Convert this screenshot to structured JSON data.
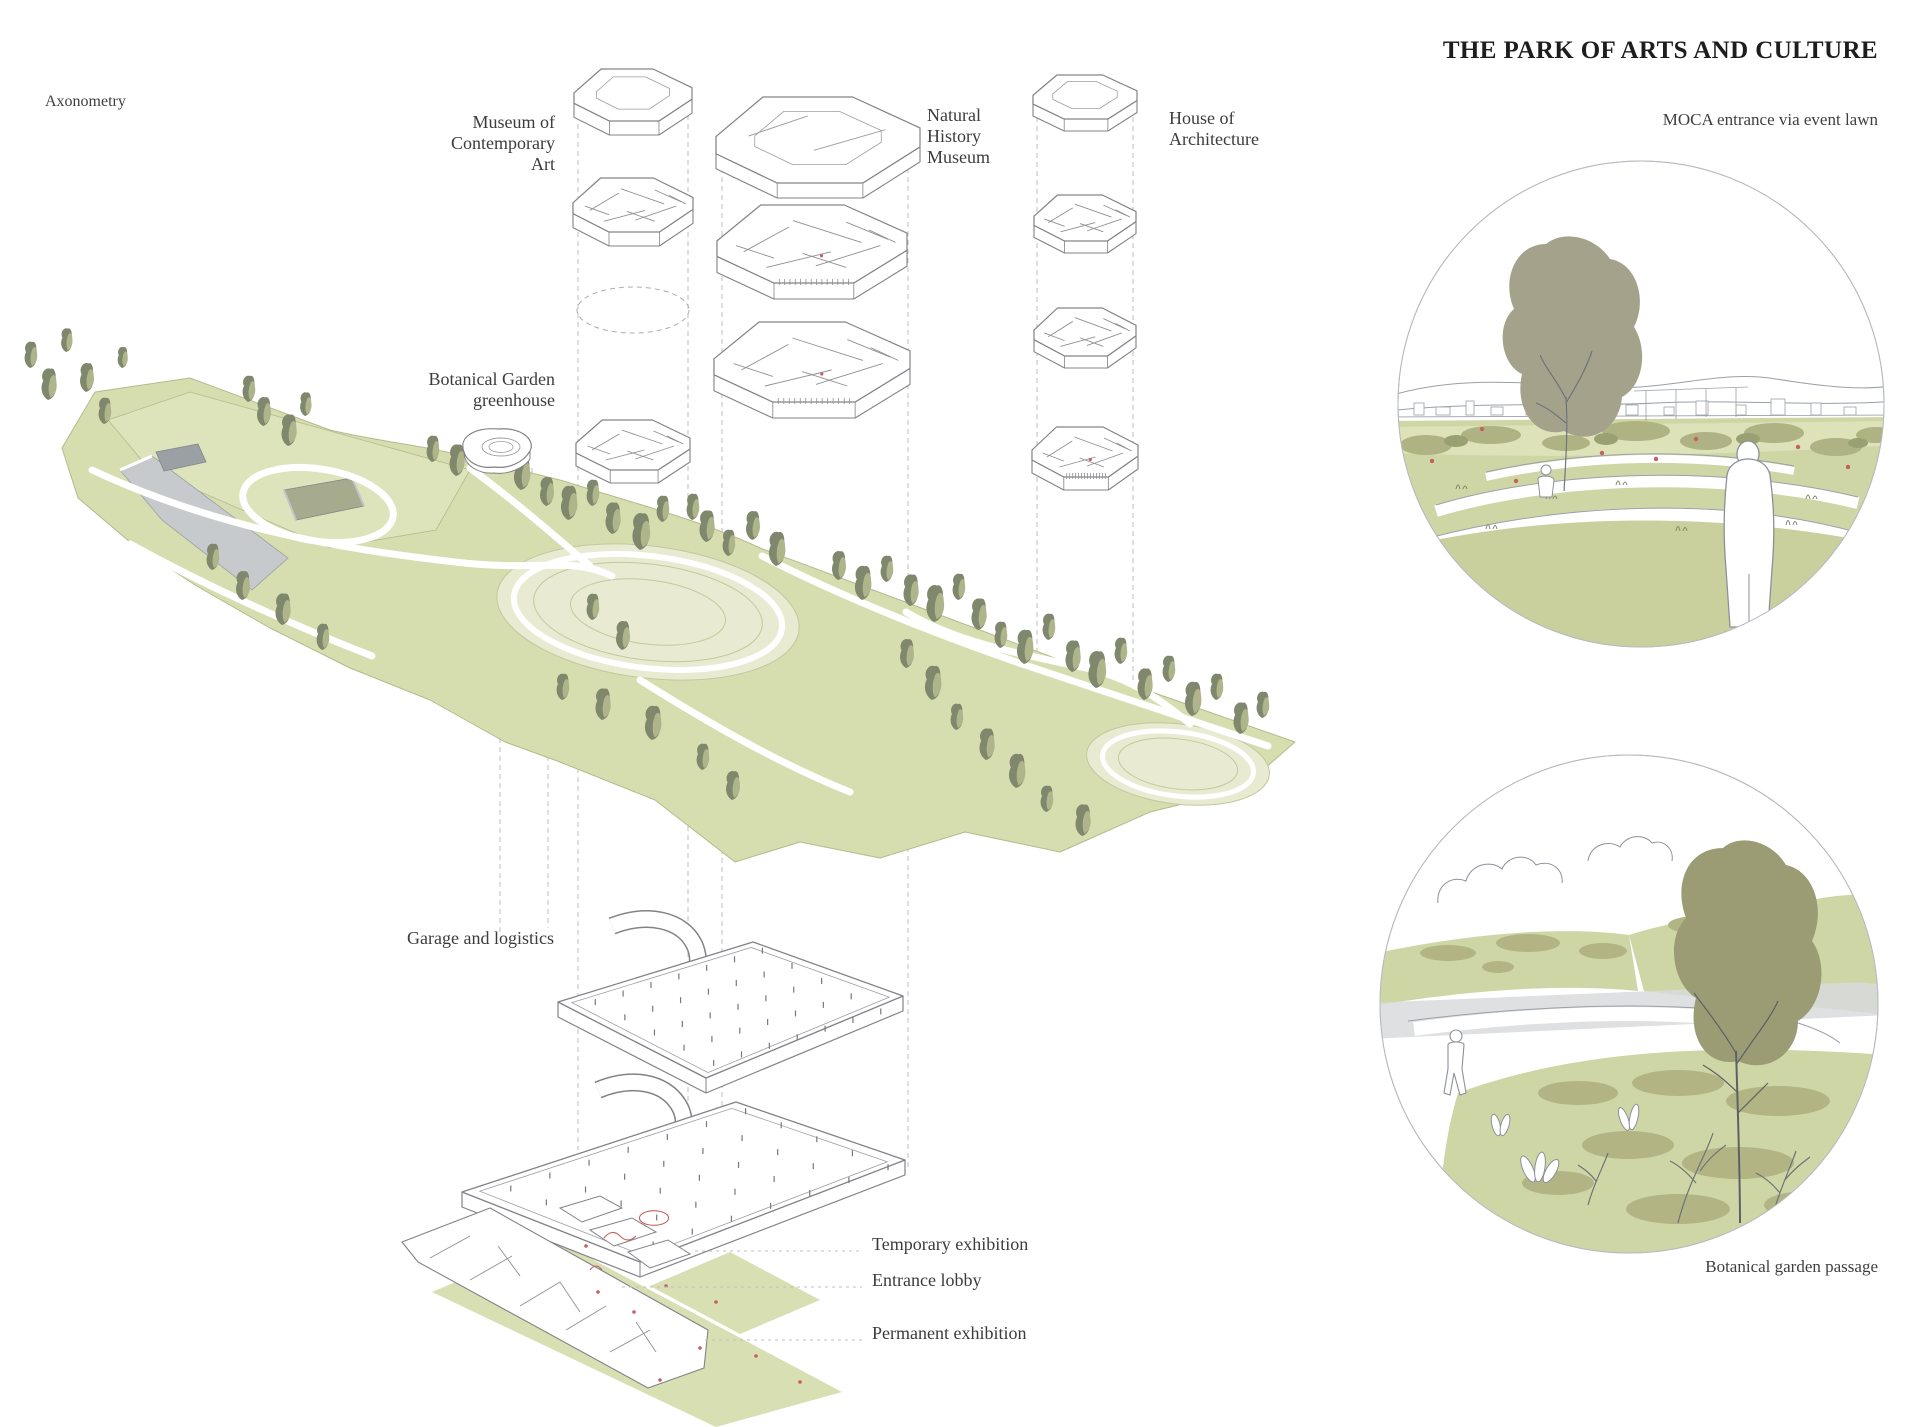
{
  "header": {
    "title": "THE PARK OF ARTS AND CULTURE"
  },
  "diagram": {
    "view_label": "Axonometry",
    "labels": {
      "moca": "Museum of\nContemporary\nArt",
      "nhm": "Natural\nHistory\nMuseum",
      "hoa": "House of\nArchitecture",
      "greenhouse": "Botanical Garden\ngreenhouse",
      "garage": "Garage and logistics",
      "temporary": "Temporary exhibition",
      "lobby": "Entrance lobby",
      "permanent": "Permanent exhibition"
    }
  },
  "vignettes": {
    "moca_entrance": {
      "caption": "MOCA entrance via event lawn"
    },
    "botanical_passage": {
      "caption": "Botanical garden passage"
    }
  },
  "colors": {
    "park_green": "#d6ddae",
    "plateau_green": "#dde3ba",
    "lawn_fill": "#e8ebd2",
    "vignette_green": "#cfd6a6",
    "vignette_green_dark": "#c9d09e",
    "bush_olive": "#afb383",
    "tree_lit": "#aeb58a",
    "tree_shade": "#7f876c",
    "tree_gray_olive": "#a5a28c",
    "tree_dark_olive": "#9b9c74",
    "sketch_line": "#8b909a",
    "drawing_line": "#808387",
    "guide_gray": "#bcbfc3",
    "wall_gray": "#c7cacc",
    "accent_red": "#c4615f",
    "title_ink": "#1d1d1f",
    "label_ink": "#3c3c3e"
  }
}
